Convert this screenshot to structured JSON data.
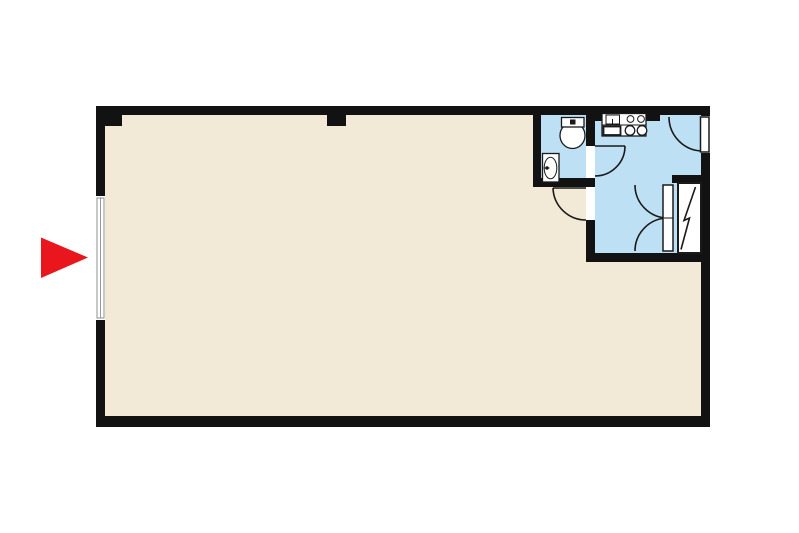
{
  "document": {
    "type": "floor-plan-diagram",
    "visible_text": "none"
  },
  "colors": {
    "background": "#ffffff",
    "wall": "#121212",
    "floor-main": "#f2e9d7",
    "floor-wet": "#bee0f4",
    "fixture": "#ffffff",
    "line": "#1a1a1a",
    "window-line": "#8c9094",
    "arrow": "#e9161d"
  },
  "rooms": [
    {
      "id": "main-room",
      "floor_color": "#f2e9d7",
      "features": [
        "window-on-left-wall",
        "door-from-hall"
      ]
    },
    {
      "id": "toilet-room",
      "floor_color": "#bee0f4",
      "fixtures": [
        "toilet",
        "wash-basin"
      ]
    },
    {
      "id": "kitchen-hall",
      "floor_color": "#bee0f4",
      "fixtures": [
        "kitchen-sink",
        "two-burner-stove"
      ],
      "features": [
        "entrance-door-top-right",
        "double-door",
        "utility-shaft"
      ]
    }
  ],
  "icons": {
    "entrance_arrow": "red-right-pointing-triangle",
    "shaft_symbol": "zigzag-bolt",
    "window_symbol": "double-line-window",
    "stove_symbol": "two-circles",
    "toilet_symbol": "tank-and-bowl"
  }
}
